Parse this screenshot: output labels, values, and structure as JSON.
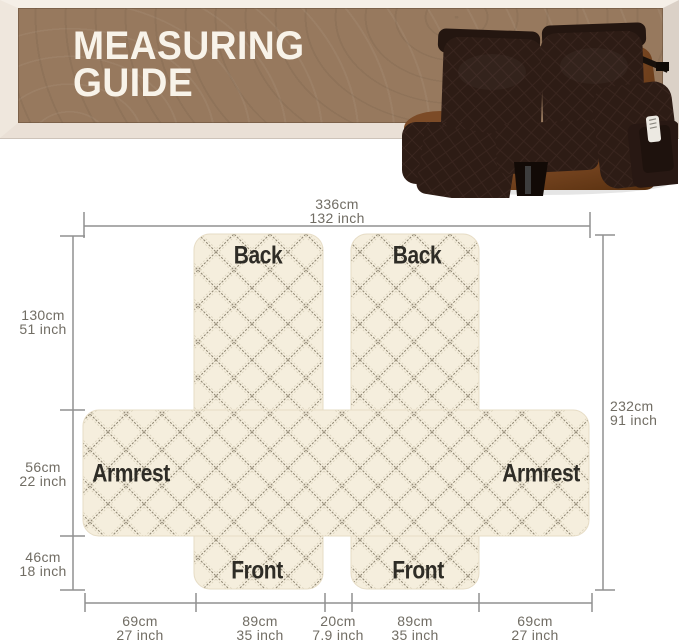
{
  "header": {
    "title_line1": "MEASURING",
    "title_line2": "GUIDE"
  },
  "sofa": {
    "description": "brown quilted recliner loveseat cover on leather loveseat"
  },
  "diagram": {
    "panel_labels": {
      "back_left": "Back",
      "back_right": "Back",
      "armrest_left": "Armrest",
      "armrest_right": "Armrest",
      "front_left": "Front",
      "front_right": "Front"
    },
    "dimensions": {
      "top": {
        "cm": "336cm",
        "inch": "132 inch"
      },
      "left_back": {
        "cm": "130cm",
        "inch": "51 inch"
      },
      "left_armrest": {
        "cm": "56cm",
        "inch": "22 inch"
      },
      "left_front": {
        "cm": "46cm",
        "inch": "18 inch"
      },
      "right_total": {
        "cm": "232cm",
        "inch": "91 inch"
      },
      "bottom_1": {
        "cm": "69cm",
        "inch": "27 inch"
      },
      "bottom_2": {
        "cm": "89cm",
        "inch": "35 inch"
      },
      "bottom_3": {
        "cm": "20cm",
        "inch": "7.9 inch"
      },
      "bottom_4": {
        "cm": "89cm",
        "inch": "35 inch"
      },
      "bottom_5": {
        "cm": "69cm",
        "inch": "27 inch"
      }
    },
    "colors": {
      "fabric": "#f5eedd",
      "stitch": "#877e69",
      "dimension_line": "#909090",
      "dimension_text": "#716d64",
      "panel_text": "#2e2c26",
      "banner_wood": "#97795e",
      "banner_frame": "#efe7dd",
      "title_text": "#f8f3e9",
      "sofa_cover": "#2d1c15",
      "sofa_leather": "#7b4a26"
    }
  }
}
